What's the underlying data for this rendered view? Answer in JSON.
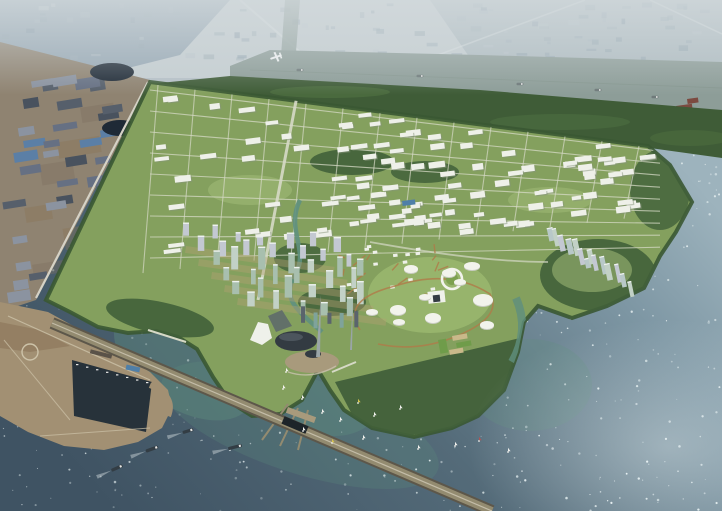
{
  "scene": {
    "description": "Aerial masterplan rendering of a coastal eco-city: gridded industrial park, waterfront tower district with egg-shaped landmark and spires, dome-filled park island, sculptural tower peninsula, breakwater port with harbor basin, long sea dike, ships and sailboats on sparkling water, hazy existing city and river beyond",
    "colors": {
      "haze": "#b6c1c7",
      "hazeTop": "#d3dadd",
      "distantInd": "#98a9b5",
      "distantIndDark": "#7e92a1",
      "fieldLight": "#c6cfd2",
      "mosaic1": "#a3b2bc",
      "mosaic2": "#8da0ad",
      "mosaic3": "#bac5cb",
      "mosaic4": "#94a7b0",
      "mosaic5": "#7f94a3",
      "roadDistant": "#dde3e4",
      "riverWater": "#8d9d98",
      "riverEdge": "#7b8d82",
      "barge": "#6f7a7a",
      "planeWhite": "#f4f6f6",
      "redShed": "#7c4a40",
      "redShed2": "#8a5a4e",
      "whiteShed": "#d8d8d2",
      "marsh": "#3f5c37",
      "marshLight": "#567745",
      "oldGround": "#8f8371",
      "oldGroundDark": "#7c7161",
      "warehouse1": "#667083",
      "warehouse2": "#565f6b",
      "warehouse3": "#49525e",
      "warehouse4": "#5b7fa6",
      "warehouse5": "#8b93a0",
      "pond": "#1f2a36",
      "boundaryRoad": "#d5d2c6",
      "devGreen": "#84a05e",
      "blockLight": "#a2bc78",
      "lawn": "#9dbb72",
      "treeDark": "#3a5833",
      "forest": "#41603a",
      "roadLight": "#d6d9c6",
      "bldgWhite": "#eef0e9",
      "bldgShadow": "#86947b",
      "blueSlab": "#4f7fa8",
      "orangePath": "#b07a48",
      "towerPale": "#c3c8d2",
      "towerGreen": "#a8bfae",
      "towerGreen2": "#c2d1c6",
      "towerGlass": "#b8c8c8",
      "towerCap": "#eef2ef",
      "groundTan": "#b39f74",
      "canal": "#5f9080",
      "bayTeal": "#5f8f7e",
      "seaDeep": "#3f5363",
      "seaBase": "#546b79",
      "seaLight": "#7e97a4",
      "seaGlint": "#9db3bd",
      "sparkle": "#e8f1f2",
      "glintWhite": "#e4eef1",
      "portLand": "#a29073",
      "portBrown": "#8a7558",
      "portRoad": "#cdc3a9",
      "basin": "#27323a",
      "quay": "#5a5248",
      "dikeSide": "#5d574a",
      "dikeTop": "#938b70",
      "dikeRoad": "#c9c2ae",
      "sluice": "#1d2429",
      "shipHull": "#333d44",
      "shipDeck": "#e8e8e6",
      "wake": "#d4dee0",
      "sailWhite": "#f2f2ee",
      "sailYellow": "#d6c44e",
      "sailRed": "#b05050",
      "domeWhite": "#f2f3ec",
      "domeShade": "#c9ccc2",
      "landmarkDark": "#333b42",
      "landmarkMid": "#5a646c",
      "plaza": "#a89a7c",
      "spire": "#9aa5a8",
      "towerTeal": "#7fa39b",
      "courtGreen": "#6f9c4a",
      "courtTan": "#c9b98a",
      "archWhite": "#eff1ea",
      "ringGreen": "#7da050"
    },
    "counts": {
      "distant_mosaic_blocks": 90,
      "old_zone_warehouses": 30,
      "new_town_buildings": 113,
      "city_towers": 42,
      "right_peninsula_towers": 14,
      "village_houses": 16,
      "park_domes": 11,
      "cargo_ships": 4,
      "sailboats": 15,
      "river_barges": 5,
      "sea_sparkles": 650
    },
    "objects": {
      "ships": [
        [
          152,
          449,
          -20,
          13
        ],
        [
          188,
          431,
          -17,
          11
        ],
        [
          235,
          447,
          -14,
          14
        ],
        [
          117,
          468,
          -24,
          12
        ]
      ],
      "sailboats": [
        [
          283,
          389,
          "sailWhite"
        ],
        [
          302,
          399,
          "sailWhite"
        ],
        [
          322,
          413,
          "sailWhite"
        ],
        [
          340,
          421,
          "sailWhite"
        ],
        [
          358,
          403,
          "sailYellow"
        ],
        [
          374,
          416,
          "sailWhite"
        ],
        [
          400,
          409,
          "sailWhite"
        ],
        [
          303,
          431,
          "sailWhite"
        ],
        [
          332,
          443,
          "sailYellow"
        ],
        [
          363,
          439,
          "sailWhite"
        ],
        [
          418,
          449,
          "sailWhite"
        ],
        [
          455,
          446,
          "sailWhite"
        ],
        [
          479,
          441,
          "sailRed"
        ],
        [
          508,
          452,
          "sailWhite"
        ],
        [
          286,
          372,
          "sailWhite"
        ]
      ],
      "riverBarges": [
        [
          300,
          70
        ],
        [
          420,
          76
        ],
        [
          520,
          84
        ],
        [
          598,
          90
        ],
        [
          655,
          97
        ]
      ],
      "parkDomes": [
        [
          472,
          266,
          8,
          4
        ],
        [
          449,
          273,
          7,
          4
        ],
        [
          411,
          269,
          7,
          4
        ],
        [
          398,
          310,
          8,
          5
        ],
        [
          433,
          318,
          8,
          5
        ],
        [
          483,
          300,
          10,
          6
        ],
        [
          487,
          325,
          7,
          4
        ],
        [
          399,
          322,
          6,
          3
        ],
        [
          460,
          282,
          6,
          3
        ],
        [
          425,
          297,
          6,
          3
        ],
        [
          372,
          312,
          6,
          3
        ]
      ],
      "courts": [
        [
          452,
          336,
          15,
          5,
          "courtTan"
        ],
        [
          456,
          343,
          15,
          5,
          "courtGreen"
        ],
        [
          449,
          350,
          14,
          5,
          "courtTan"
        ],
        [
          438,
          340,
          8,
          14,
          "courtGreen"
        ]
      ],
      "redSheds": [
        [
          676,
          106,
          16,
          7,
          "redShed"
        ],
        [
          694,
          112,
          18,
          8,
          "redShed2"
        ],
        [
          687,
          99,
          11,
          5,
          "redShed"
        ],
        [
          708,
          117,
          12,
          6,
          "whiteShed"
        ]
      ],
      "ponds": [
        [
          112,
          72,
          22,
          9
        ],
        [
          120,
          128,
          18,
          8
        ]
      ],
      "spires": [
        [
          318,
          295,
          321,
          357,
          4
        ],
        [
          351,
          300,
          353,
          350,
          2
        ]
      ],
      "plane": [
        276,
        57
      ]
    }
  }
}
